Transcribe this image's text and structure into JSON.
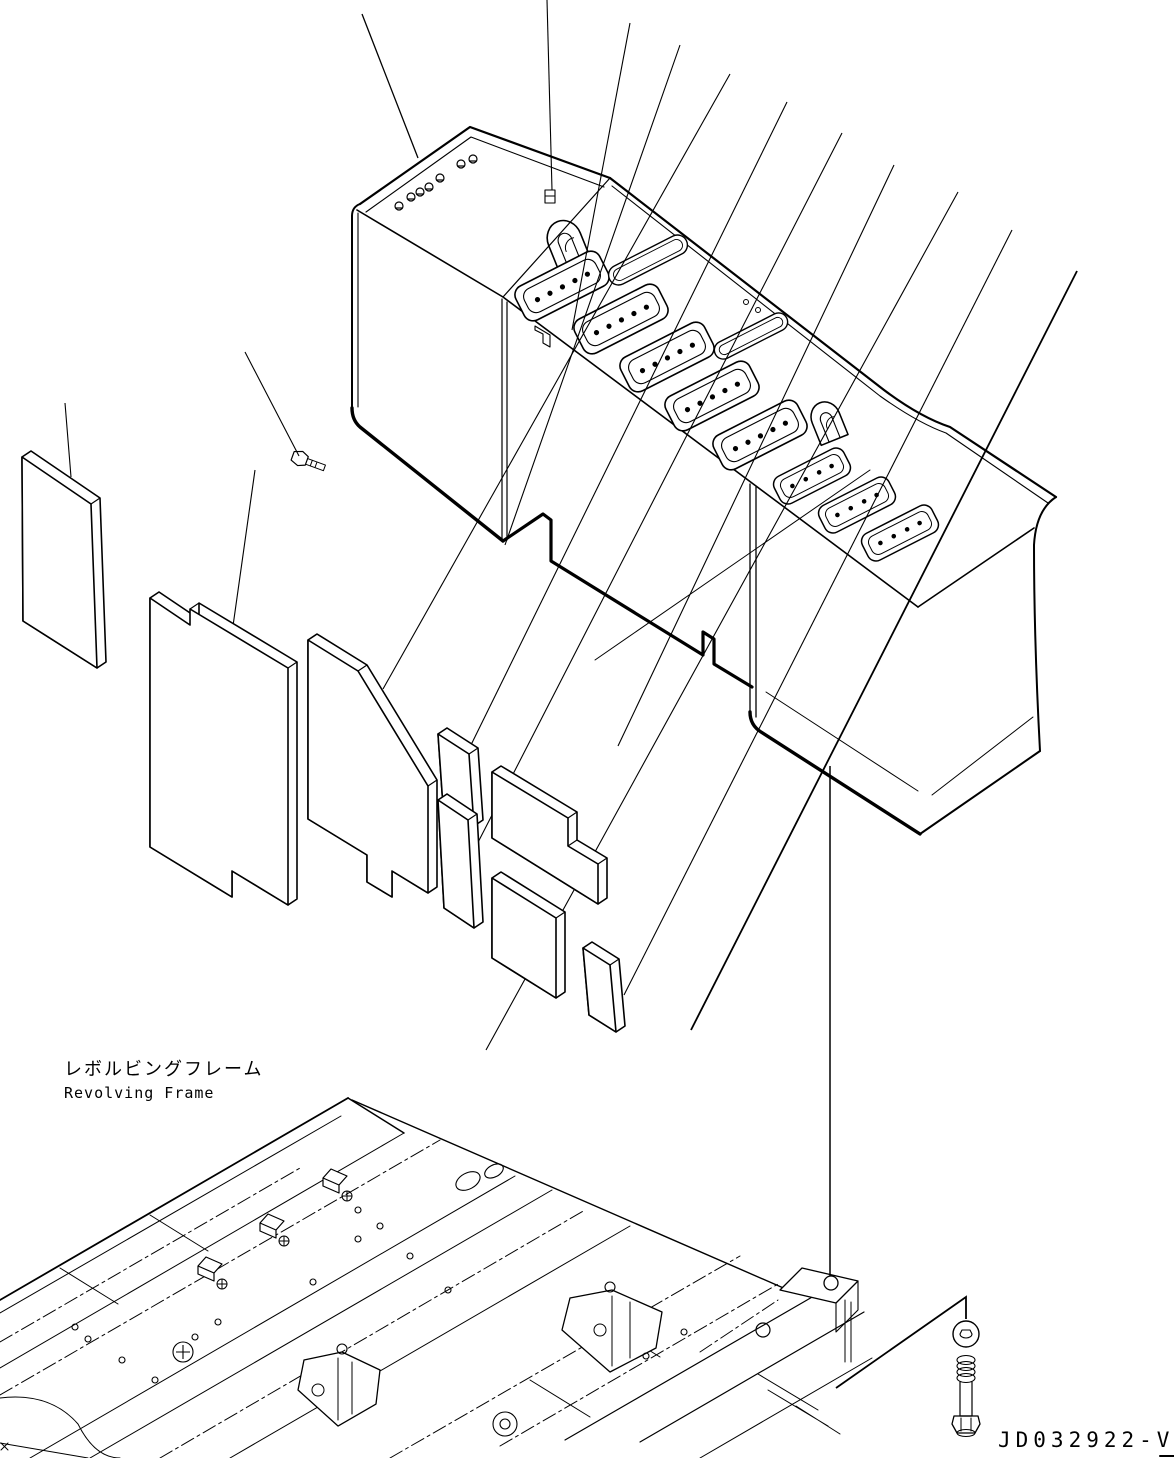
{
  "page": {
    "background": "#ffffff",
    "line_color": "#000000"
  },
  "diagram": {
    "type": "exploded-parts-view",
    "labels": {
      "revolving_frame_ja": "レボルビングフレーム",
      "revolving_frame_en": "Revolving Frame",
      "drawing_number": "JD032922-V"
    },
    "counts": {
      "vent_grilles": 8,
      "plain_slots": 2,
      "lift_handles": 2,
      "cover_top_bolts": 7,
      "foam_pads": 8,
      "leader_lines": 16
    }
  }
}
